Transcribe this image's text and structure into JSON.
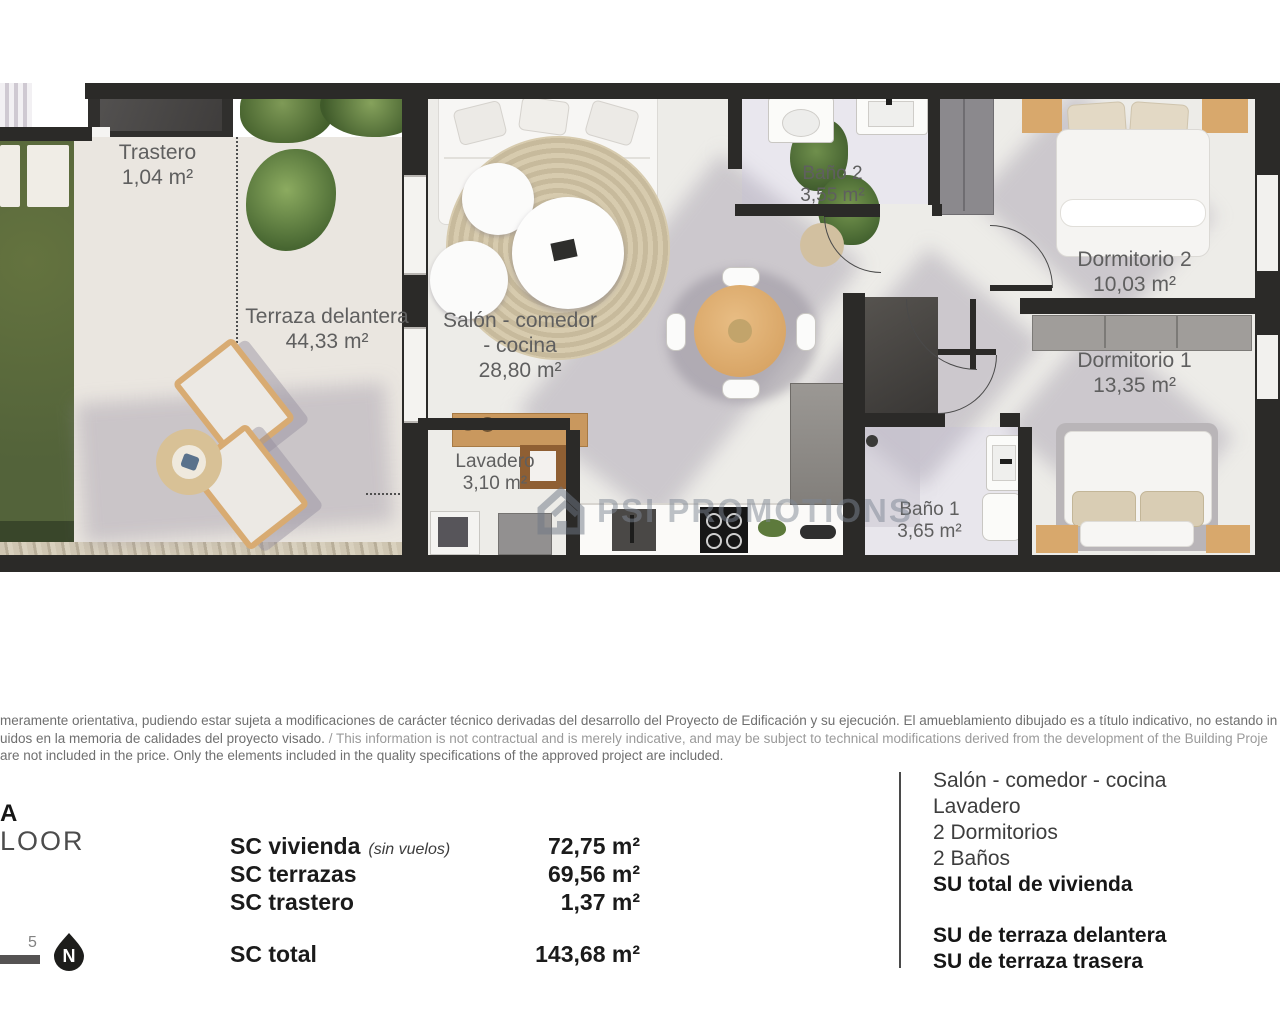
{
  "plan": {
    "watermark_text": "PSI PROMOTIONS",
    "rooms": {
      "trastero": {
        "name": "Trastero",
        "area": "1,04 m²"
      },
      "terraza": {
        "name": "Terraza delantera",
        "area": "44,33 m²"
      },
      "salon": {
        "name_line1": "Salón - comedor",
        "name_line2": "- cocina",
        "area": "28,80 m²"
      },
      "lavadero": {
        "name": "Lavadero",
        "area": "3,10 m²"
      },
      "bano2": {
        "name": "Baño 2",
        "area": "3,55 m²"
      },
      "dormitorio2": {
        "name": "Dormitorio 2",
        "area": "10,03 m²"
      },
      "dormitorio1": {
        "name": "Dormitorio 1",
        "area": "13,35 m²"
      },
      "bano1": {
        "name": "Baño 1",
        "area": "3,65 m²"
      }
    },
    "colors": {
      "wall": "#2b2a28",
      "grass": "#5c6b40",
      "wood": "#d9ab72",
      "floor": "#edece8"
    }
  },
  "disclaimer": {
    "line1": "meramente orientativa, pudiendo estar sujeta a modificaciones de carácter técnico derivadas del desarrollo del Proyecto de Edificación y su ejecución. El amueblamiento dibujado es a título indicativo, no estando in",
    "line2_es": "uidos en la memoria de calidades del proyecto visado. ",
    "line2_en": "/ This information is not contractual and is merely indicative, and may be subject to technical modifications derived from the development of the Building Proje",
    "line3": "are not included in the price. Only the elements included in the quality specifications of the approved project are included."
  },
  "footer": {
    "title_partial": "A",
    "floor_partial": "LOOR",
    "scale_number": "5",
    "compass_letter": "N",
    "sc_rows": [
      {
        "label": "SC vivienda",
        "note": "(sin vuelos)",
        "value": "72,75 m²"
      },
      {
        "label": "SC terrazas",
        "note": "",
        "value": "69,56 m²"
      },
      {
        "label": "SC trastero",
        "note": "",
        "value": "1,37 m²"
      }
    ],
    "sc_total": {
      "label": "SC total",
      "value": "143,68 m²"
    },
    "legend_items": [
      "Salón - comedor - cocina",
      "Lavadero",
      "2 Dormitorios",
      "2 Baños",
      "SU total de vivienda"
    ],
    "legend_su_items": [
      "SU de terraza delantera",
      "SU de terraza trasera"
    ]
  }
}
